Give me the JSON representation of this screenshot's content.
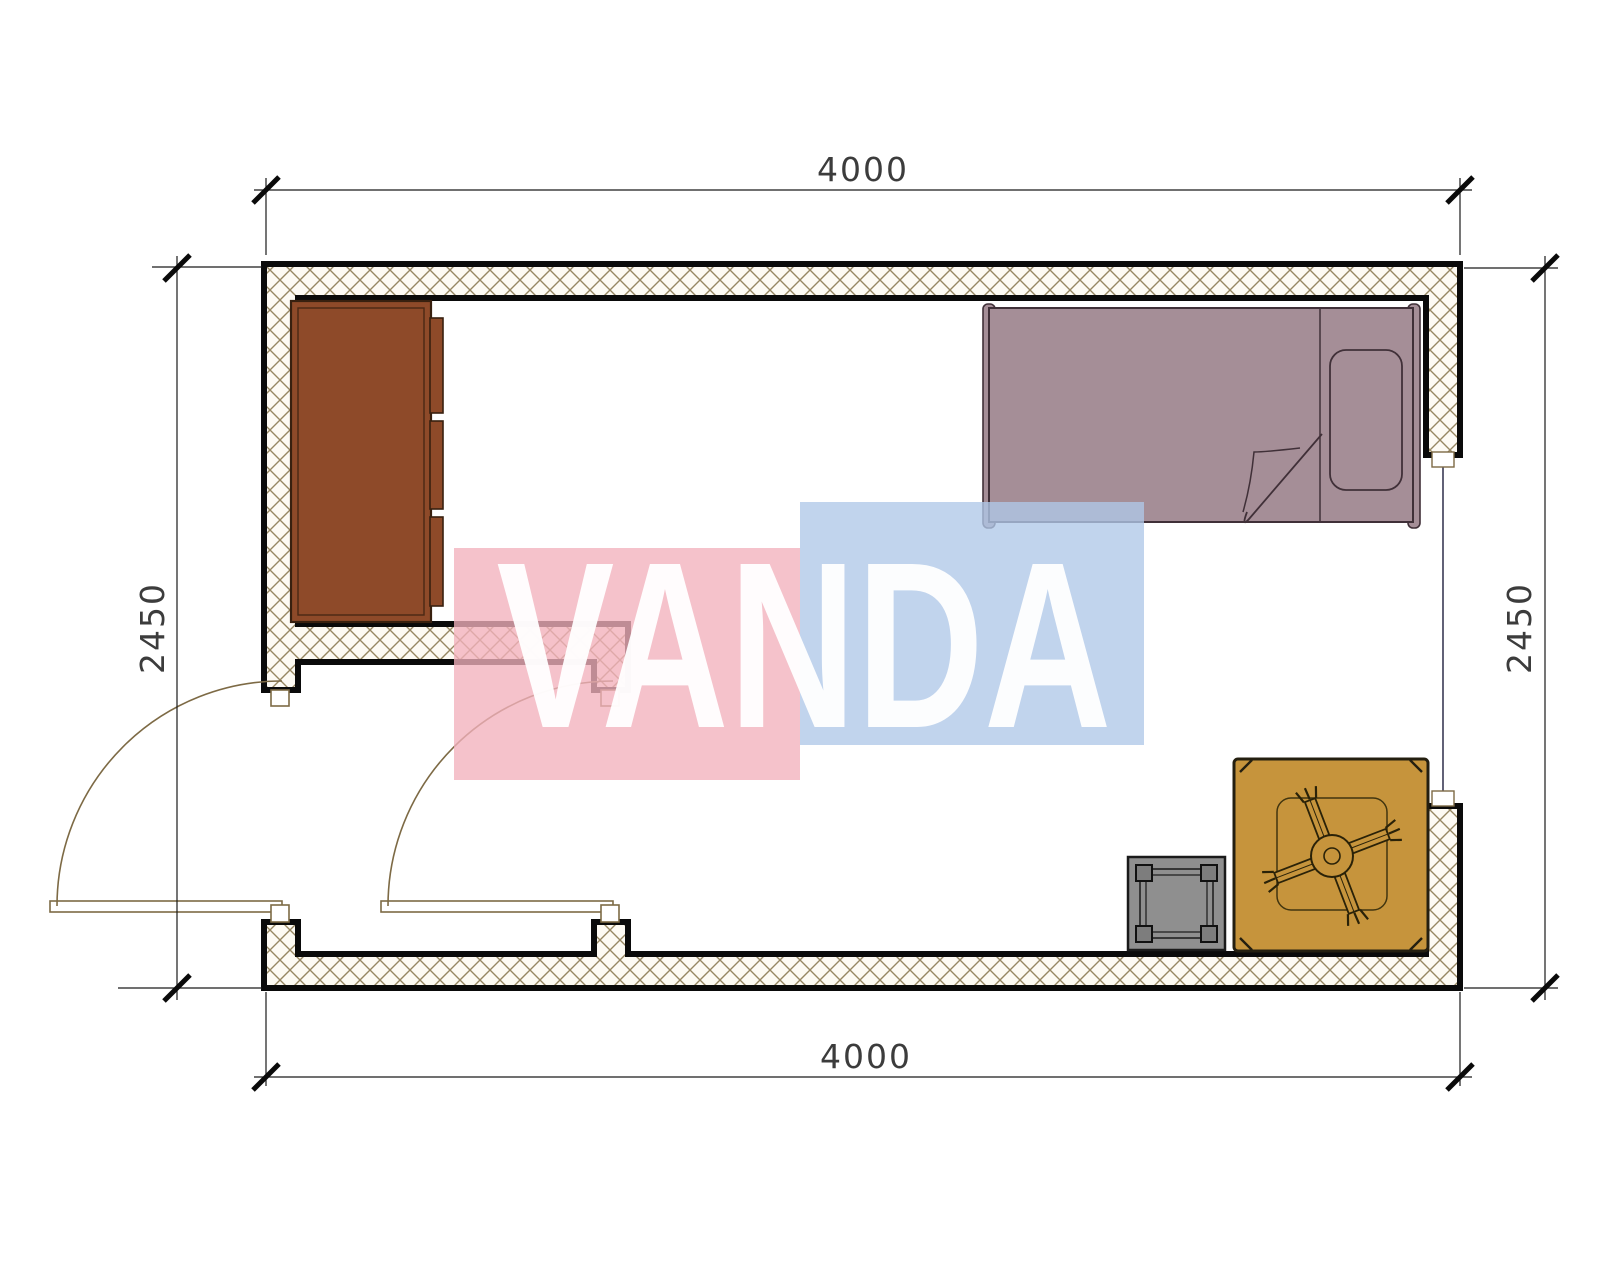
{
  "dimensions": {
    "top": "4000",
    "bottom": "4000",
    "left": "2450",
    "right": "2450"
  },
  "watermark": {
    "text": "VANDA",
    "pink": "rgba(242,177,188,0.78)",
    "blue": "rgba(176,200,232,0.78)",
    "text_color": "rgba(255,255,255,0.95)"
  },
  "colors": {
    "wall_line": "#0a0a0a",
    "wall_hatch": "#978762",
    "wall_fill": "#fdfaf3",
    "door": "#7d6a45",
    "window_line": "#3a3a55",
    "wardrobe": "#8e4a29",
    "wardrobe_line": "#38200f",
    "bed": "#a58e97",
    "bed_line": "#403038",
    "table": "#c6943c",
    "table_line": "#241f10",
    "stool": "#8f8f8f",
    "stool_leg": "#7d7d7d",
    "dim_text": "#3c3c3c"
  },
  "furniture": [
    {
      "name": "wardrobe",
      "location": "top-left"
    },
    {
      "name": "single-bed",
      "location": "top-right"
    },
    {
      "name": "low-table-with-fan",
      "location": "bottom-right"
    },
    {
      "name": "stool",
      "location": "bottom-right"
    }
  ],
  "openings": [
    {
      "name": "entry-door-left",
      "type": "swing-door"
    },
    {
      "name": "entry-door-middle",
      "type": "swing-door"
    },
    {
      "name": "window-right",
      "type": "window"
    }
  ]
}
